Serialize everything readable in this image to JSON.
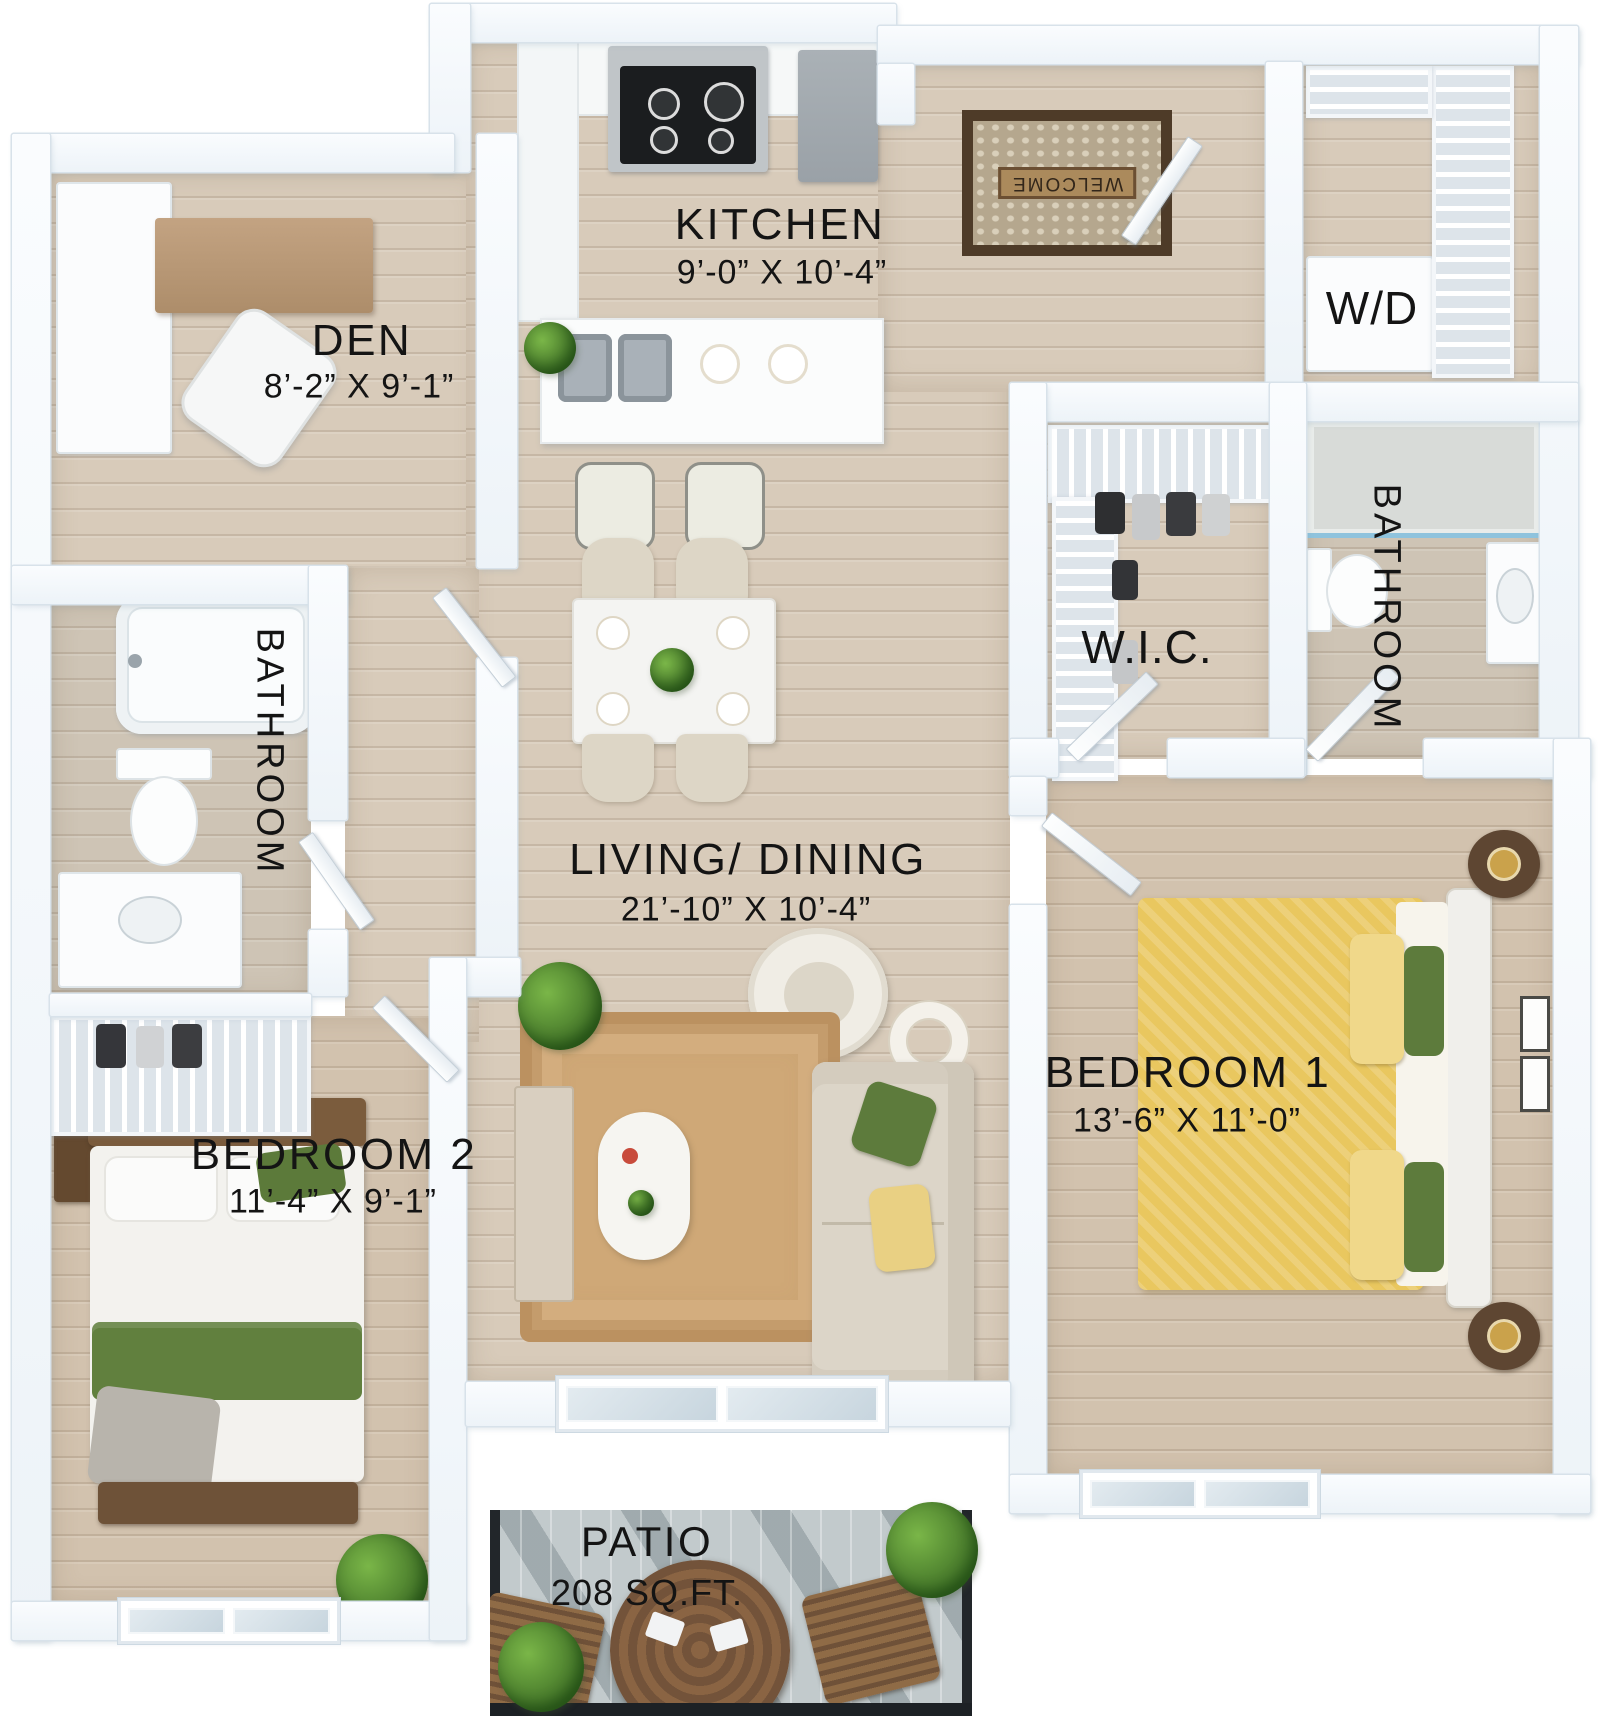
{
  "rooms": {
    "kitchen": {
      "name": "KITCHEN",
      "dims": "9’-0” X 10’-4”"
    },
    "den": {
      "name": "DEN",
      "dims": "8’-2” X 9’-1”"
    },
    "washer_dryer": {
      "name": "W/D"
    },
    "wic": {
      "name": "W.I.C."
    },
    "bathroom_right": {
      "name": "BATHROOM"
    },
    "bathroom_left": {
      "name": "BATHROOM"
    },
    "living_dining": {
      "name": "LIVING/ DINING",
      "dims": "21’-10” X 10’-4”"
    },
    "bedroom1": {
      "name": "BEDROOM 1",
      "dims": "13’-6” X 11’-0”"
    },
    "bedroom2": {
      "name": "BEDROOM 2",
      "dims": "11’-4” X 9’-1”"
    },
    "patio": {
      "name": "PATIO",
      "dims": "208 SQ.FT."
    }
  },
  "decor": {
    "welcome_mat": "WELCOME"
  },
  "colors": {
    "wall": "#f4f8fb",
    "floor_wood": "#d8cbba",
    "bed1_duvet": "#e9c75f",
    "accent_green": "#5d7b3c",
    "rug": "#c9a271",
    "patio_floor": "#c2cacc"
  }
}
